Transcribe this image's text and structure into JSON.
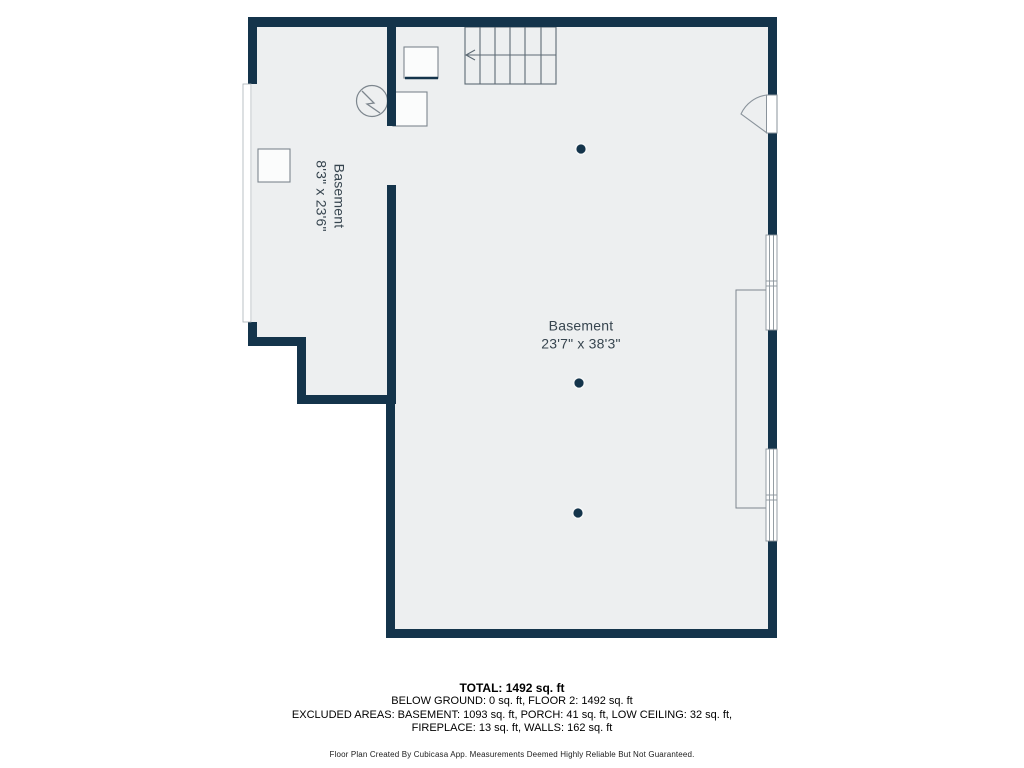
{
  "colors": {
    "wall": "#14344b",
    "floor": "#edeff0",
    "symbol_outline": "#7d868e",
    "label_text": "#37454f"
  },
  "floor_plan": {
    "rooms": [
      {
        "name": "Basement",
        "dimensions": "23'7\" x 38'3\""
      },
      {
        "name": "Basement",
        "dimensions": "8'3\" x 23'6\""
      }
    ],
    "icons": [
      "stairs-icon",
      "entry-door-icon",
      "window-icon",
      "water-heater-icon",
      "appliance-icon",
      "storage-box-icon",
      "column-dot"
    ]
  },
  "footer": {
    "total": "TOTAL: 1492 sq. ft",
    "area_line": "BELOW GROUND: 0 sq. ft, FLOOR 2: 1492 sq. ft",
    "excluded_line1": "EXCLUDED AREAS: BASEMENT: 1093 sq. ft, PORCH: 41 sq. ft, LOW CEILING: 32 sq. ft,",
    "excluded_line2": "FIREPLACE: 13 sq. ft, WALLS: 162 sq. ft",
    "disclaimer": "Floor Plan Created By Cubicasa App. Measurements Deemed Highly Reliable But Not Guaranteed."
  }
}
